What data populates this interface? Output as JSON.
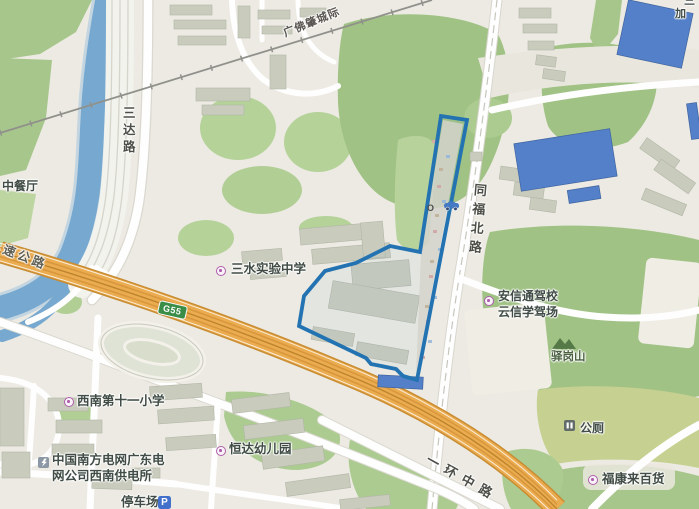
{
  "map": {
    "edge_labels": {
      "top_right_partial_1": "三",
      "top_right_partial_2": "加"
    },
    "roads": {
      "sanda": "三达路",
      "tongfu_north": "同福北路",
      "yihuan_middle": "一环中路",
      "expressway_partial": "速公路",
      "railway": "广佛肇城际",
      "g55_badge": "G55"
    },
    "pois": {
      "restaurant": "中餐厅",
      "middle_school": "三水实验中学",
      "driving_school": "安信通驾校\n云信学驾场",
      "hill": "驿岗山",
      "public_toilet": "公厕",
      "primary_school": "西南第十一小学",
      "power_company": "中国南方电网广东电\n网公司西南供电所",
      "kindergarten": "恒达幼儿园",
      "department_store": "福康来百货",
      "parking": "停车场",
      "parking_badge": "P",
      "strip_marker": "O"
    },
    "colors": {
      "selection_outline": "#1673bc",
      "highway_orange": "#f4ab40",
      "green_area": "#9cc47c",
      "water_blue": "#6fa9d7",
      "blue_roof_building": "#4b7fd3",
      "g55_shield_green": "#2e8f3e",
      "parking_blue": "#3a6fd8",
      "poi_purple": "#b55ab2"
    }
  }
}
